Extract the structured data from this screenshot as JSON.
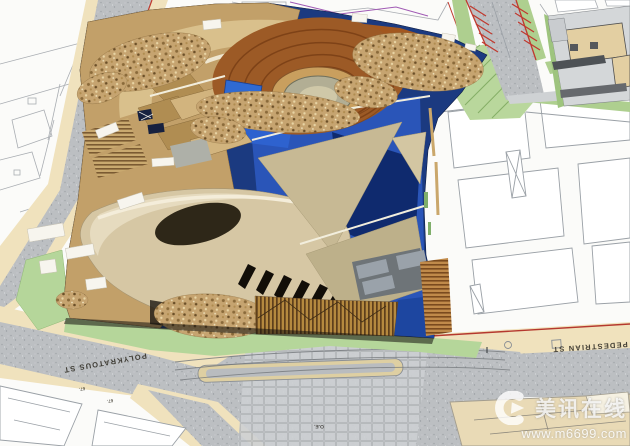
{
  "scene": {
    "title": "Architectural massing model on urban site plan",
    "description": "Cardboard and wood study model of a curvilinear building photographed over a site plan with streets, parcels and landscaping"
  },
  "plan": {
    "street_labels": {
      "left": "POLYKRATOUS ST",
      "right": "PEDESTRIAN ST"
    },
    "parcel_labels": {
      "lot_a": "67.",
      "lot_b": "67.",
      "note": "O.E."
    },
    "colors": {
      "paper": "#fbfbf9",
      "asphalt": "#b9bcbf",
      "sidewalk": "#f0e2bd",
      "lawn_green": "#b5d69a",
      "parking_stripe_red": "#c0392e",
      "parcel_line": "#9aa0a6"
    }
  },
  "model": {
    "colors": {
      "spiral_wood_brown": "#9c5a26",
      "cardboard_tan": "#c2a069",
      "metal_roof_champagne": "#d6c7a4",
      "ground_blue": "#2a55b8",
      "shadow_navy": "#14275c"
    }
  },
  "watermark": {
    "logo_icon": "m6699-logo",
    "brand": "美讯在线",
    "url": "www.m6699.com"
  }
}
